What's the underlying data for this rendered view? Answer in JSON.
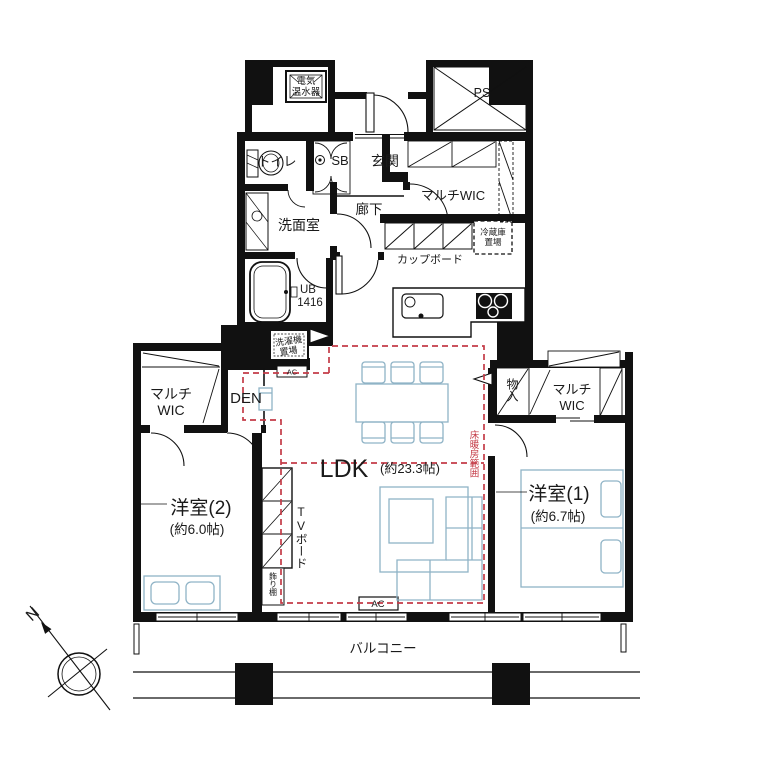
{
  "colors": {
    "wall": "#111111",
    "furniture_stroke": "#8fb3c6",
    "heating_red": "#c43b47",
    "text": "#1a1a1a",
    "background": "#ffffff"
  },
  "labels": {
    "water_heater_line1": "電気",
    "water_heater_line2": "温水器",
    "pipe_space": "PS",
    "toilet": "トイレ",
    "shoe_box": "SB",
    "entrance": "玄関",
    "multi_wic_hall": "マルチWIC",
    "washroom": "洗面室",
    "hallway": "廊下",
    "fridge_line1": "冷蔵庫",
    "fridge_line2": "置場",
    "cupboard": "カップボード",
    "unit_bath": "UB",
    "unit_bath_size": "1416",
    "washer_line1": "洗濯機",
    "washer_line2": "置場",
    "ac_den": "AC",
    "multi_wic_left_line1": "マルチ",
    "multi_wic_left_line2": "WIC",
    "den": "DEN",
    "ldk": "LDK",
    "ldk_size": "(約23.3帖)",
    "floor_heating": "床暖房範囲",
    "storage": "物入",
    "multi_wic_right_line1": "マルチ",
    "multi_wic_right_line2": "WIC",
    "bedroom1": "洋室(1)",
    "bedroom1_size": "(約6.7帖)",
    "bedroom2": "洋室(2)",
    "bedroom2_size": "(約6.0帖)",
    "tv_board": "TVボード",
    "display_shelf": "飾り棚",
    "ac_living": "AC",
    "balcony": "バルコニー",
    "compass_north": "N"
  }
}
